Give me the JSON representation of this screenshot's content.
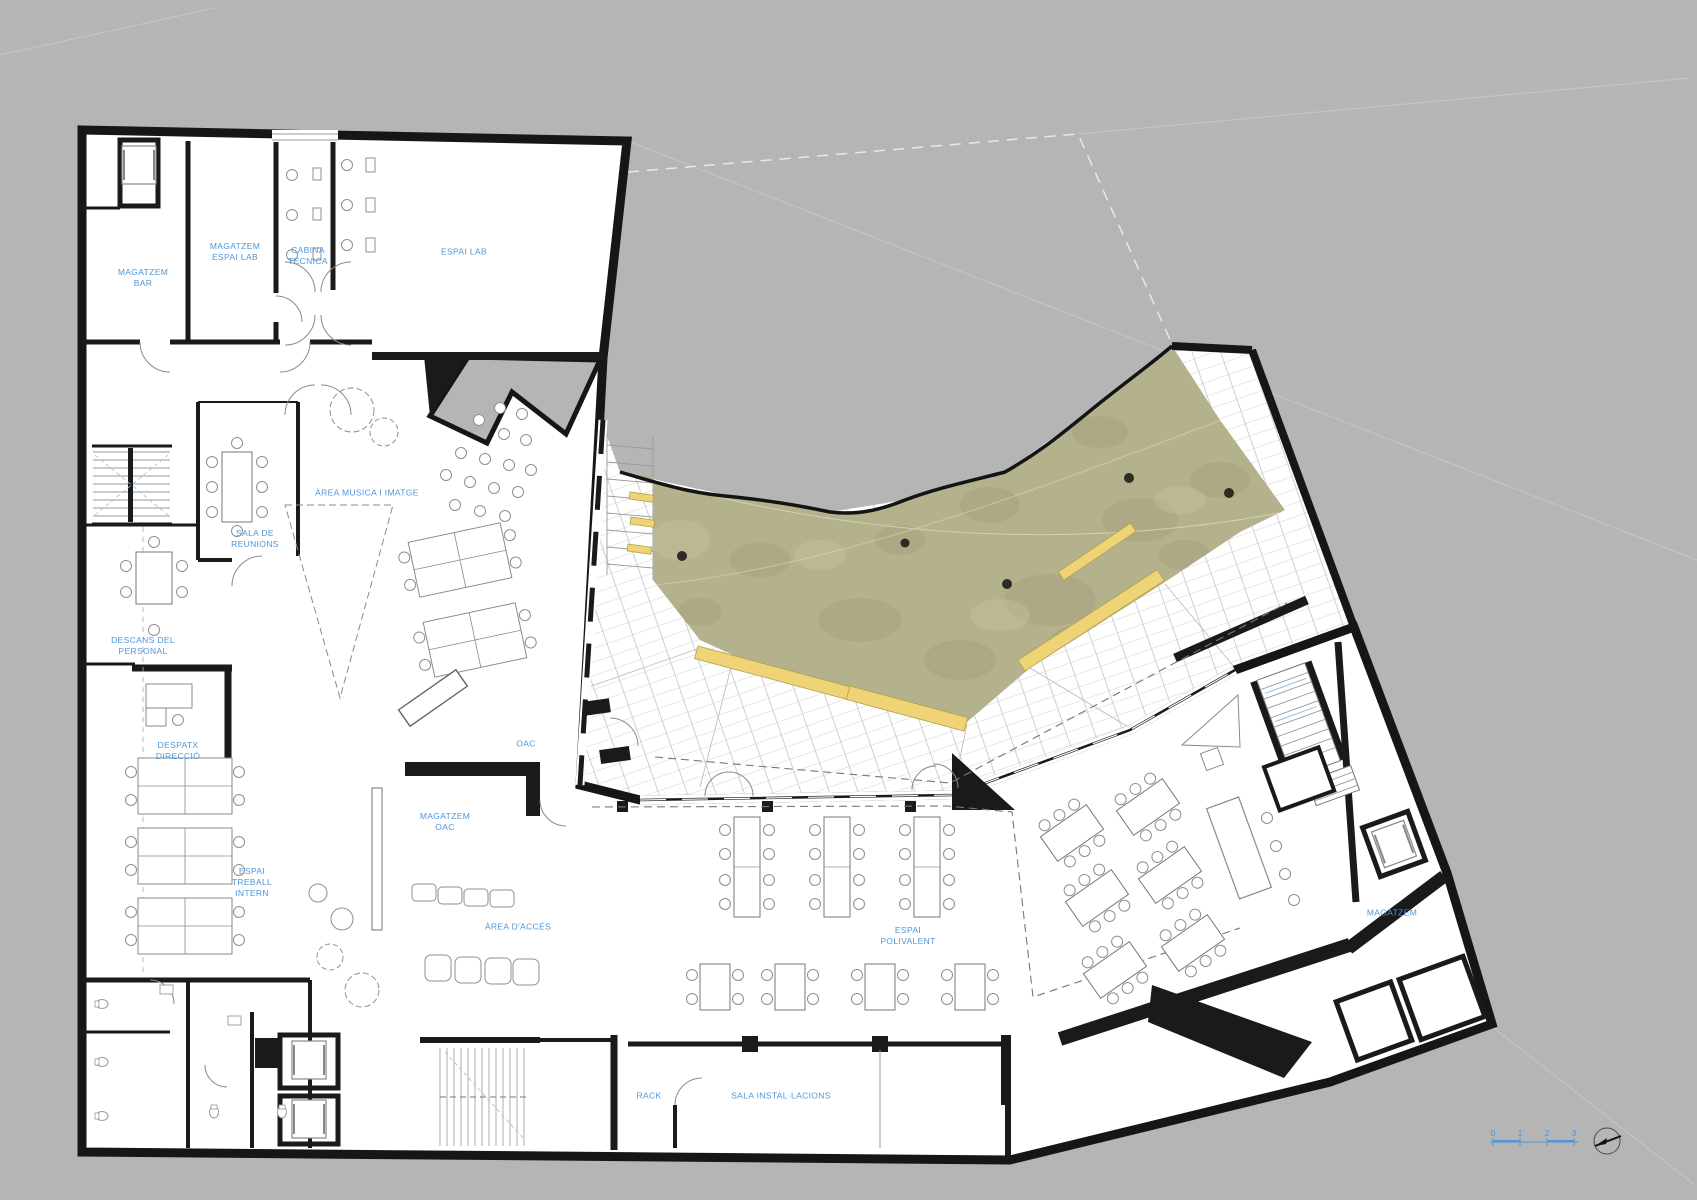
{
  "colors": {
    "background_gray": "#b5b5b5",
    "wall_black": "#1a1a1a",
    "label_blue": "#4f96d8",
    "terrain_green": "#b4b18d",
    "bench_yellow": "#eed477"
  },
  "plan": {
    "room_labels": [
      {
        "id": "magatzem-bar",
        "lines": [
          "MAGATZEM",
          "BAR"
        ],
        "x": 143,
        "y": 278
      },
      {
        "id": "magatzem-espai-lab",
        "lines": [
          "MAGATZEM",
          "ESPAI LAB"
        ],
        "x": 235,
        "y": 252
      },
      {
        "id": "cabina-tecnica",
        "lines": [
          "CABINA",
          "TECNICA"
        ],
        "x": 308,
        "y": 256
      },
      {
        "id": "espai-lab",
        "lines": [
          "ESPAI LAB"
        ],
        "x": 464,
        "y": 252
      },
      {
        "id": "area-musica-imatge",
        "lines": [
          "ÀREA MUSICA I IMATGE"
        ],
        "x": 367,
        "y": 493
      },
      {
        "id": "sala-de-reunions",
        "lines": [
          "SALA DE",
          "REUNIONS"
        ],
        "x": 255,
        "y": 539
      },
      {
        "id": "descans-del-personal",
        "lines": [
          "DESCANS DEL",
          "PERSONAL"
        ],
        "x": 143,
        "y": 646
      },
      {
        "id": "despatx-direccio",
        "lines": [
          "DESPATX",
          "DIRECCIÓ"
        ],
        "x": 178,
        "y": 751
      },
      {
        "id": "espai-treball-intern",
        "lines": [
          "ESPAI",
          "TREBALL",
          "INTERN"
        ],
        "x": 252,
        "y": 883
      },
      {
        "id": "oac",
        "lines": [
          "OAC"
        ],
        "x": 526,
        "y": 744
      },
      {
        "id": "magatzem-oac",
        "lines": [
          "MAGATZEM",
          "OAC"
        ],
        "x": 445,
        "y": 822
      },
      {
        "id": "area-dacces",
        "lines": [
          "ÀREA D'ACCÉS"
        ],
        "x": 518,
        "y": 927
      },
      {
        "id": "espai-polivalent",
        "lines": [
          "ESPAI",
          "POLIVALENT"
        ],
        "x": 908,
        "y": 936
      },
      {
        "id": "magatzem-dret",
        "lines": [
          "MAGATZEM"
        ],
        "x": 1392,
        "y": 913
      },
      {
        "id": "rack",
        "lines": [
          "RACK"
        ],
        "x": 649,
        "y": 1096
      },
      {
        "id": "sala-installacions",
        "lines": [
          "SALA INSTAL·LACIONS"
        ],
        "x": 781,
        "y": 1096
      }
    ],
    "scale_bar": {
      "ticks": [
        "0",
        "1",
        "2",
        "3"
      ],
      "x_start": 1493,
      "y": 1133,
      "spacing": 27
    }
  }
}
